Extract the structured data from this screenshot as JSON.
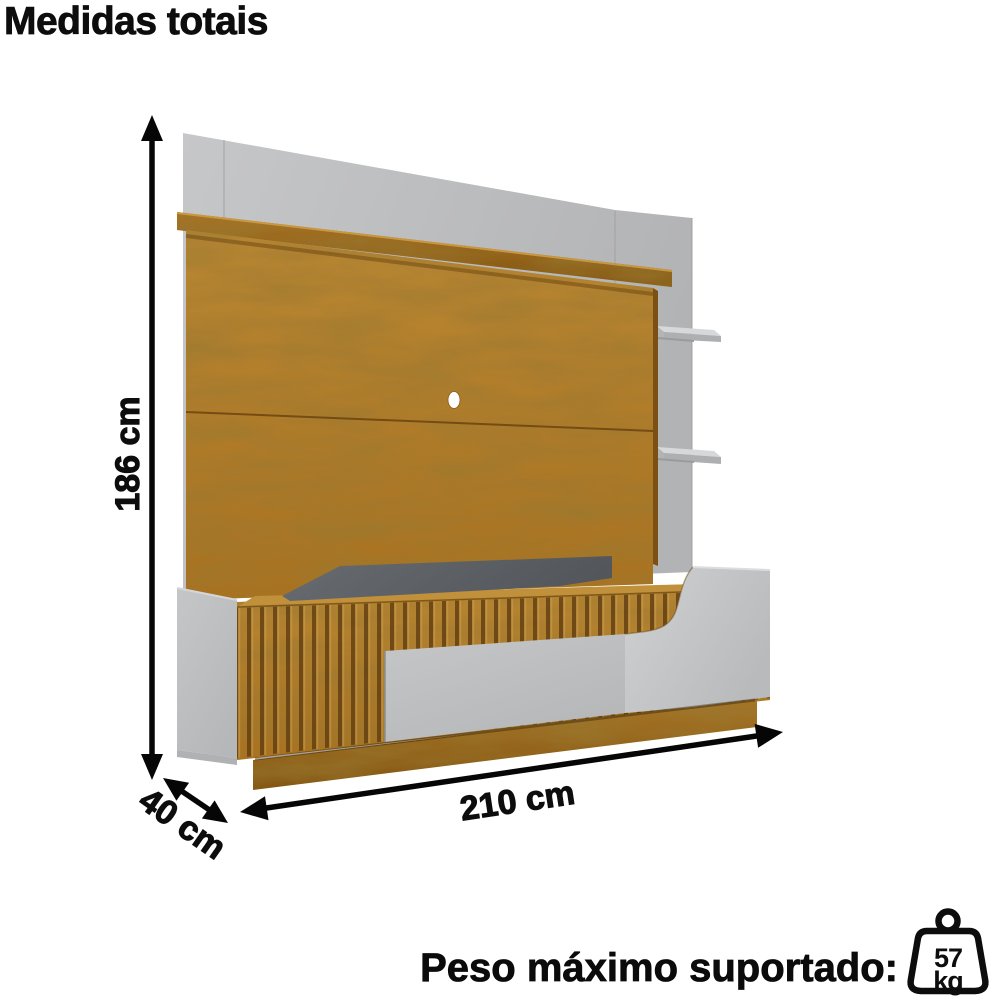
{
  "title": "Medidas totais",
  "dimensions": {
    "height_label": "186 cm",
    "width_label": "210 cm",
    "depth_label": "40 cm"
  },
  "footer": {
    "label": "Peso máximo suportado:",
    "weight_value": "57",
    "weight_unit": "kg"
  },
  "colors": {
    "wood": "#a9711f",
    "wood_dark": "#81540f",
    "panel_gray": "#c6c7c9",
    "door_gray": "#c5c6c8",
    "recess_dark": "#686c71",
    "ink": "#0d0d0d"
  }
}
